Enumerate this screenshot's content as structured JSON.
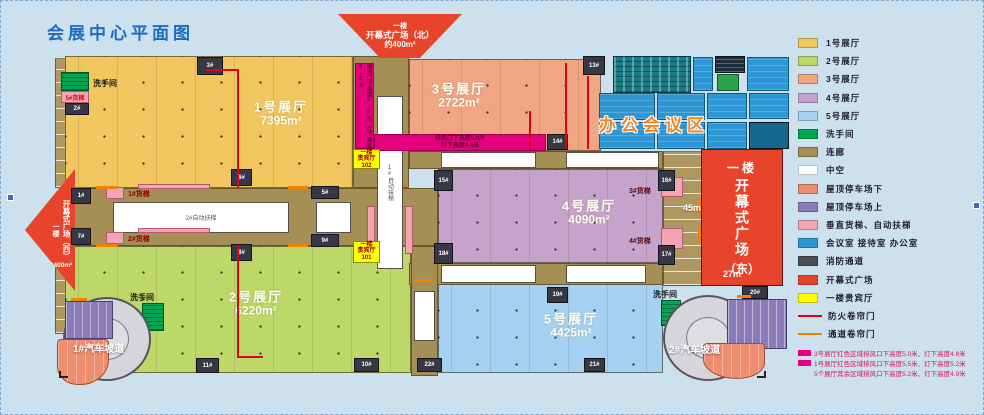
{
  "title": "会展中心平面图",
  "halls": {
    "h1": {
      "name": "1号展厅",
      "area": "7395m²"
    },
    "h2": {
      "name": "2号展厅",
      "area": "6220m²"
    },
    "h3": {
      "name": "3号展厅",
      "area": "2722m²"
    },
    "h4": {
      "name": "4号展厅",
      "area": "4090m²"
    },
    "h5": {
      "name": "5号展厅",
      "area": "4425m²"
    }
  },
  "plazas": {
    "north": {
      "floor": "一楼",
      "name": "开幕式广场（北）",
      "area": "约400m²"
    },
    "west": {
      "floor": "一楼",
      "name": "开幕式广场（西）",
      "area": "约400m²"
    },
    "east": {
      "floor": "一楼",
      "name": "开幕式广场",
      "region": "（东）",
      "dim_left": "45m",
      "dim_bottom": "27m"
    }
  },
  "office_zone": {
    "label": "办公会议区"
  },
  "vip": {
    "r102": {
      "line1": "一楼",
      "line2": "贵宾厅",
      "line3": "102"
    },
    "r101": {
      "line1": "一楼",
      "line2": "贵宾厅",
      "line3": "101"
    }
  },
  "freight": {
    "e1": "1#货梯",
    "e2": "2#货梯",
    "e3": "3#货梯",
    "e4": "4#货梯",
    "e5": "5#货梯"
  },
  "escalators": {
    "e1": "1#自动扶梯",
    "e2": "2#自动扶梯"
  },
  "restroom_label": "洗手间",
  "ramps": {
    "r1": "1#汽车坡道",
    "r2": "2#汽车坡道"
  },
  "vents": {
    "v_text": "排风口下高度5.5米、灯下高度5.2米",
    "h_line1": "排风口下高度5.0米",
    "h_line2": "灯下高度4.8米"
  },
  "stairs": [
    "1#",
    "2#",
    "3#",
    "5#",
    "6#",
    "7#",
    "8#",
    "9#",
    "10#",
    "11#",
    "13#",
    "14#",
    "15#",
    "16#",
    "17#",
    "18#",
    "19#",
    "20#",
    "21#",
    "22#"
  ],
  "legend": {
    "items": [
      {
        "label": "1号展厅",
        "color": "#f2c75f",
        "type": "swatch"
      },
      {
        "label": "2号展厅",
        "color": "#bdd868",
        "type": "swatch"
      },
      {
        "label": "3号展厅",
        "color": "#f2a583",
        "type": "swatch"
      },
      {
        "label": "4号展厅",
        "color": "#c6a3cb",
        "type": "swatch"
      },
      {
        "label": "5号展厅",
        "color": "#a5d2f2",
        "type": "swatch"
      },
      {
        "label": "洗手间",
        "color": "#00a651",
        "type": "swatch"
      },
      {
        "label": "连廊",
        "color": "#a68f55",
        "type": "swatch"
      },
      {
        "label": "中空",
        "color": "#ffffff",
        "type": "swatch"
      },
      {
        "label": "屋顶停车场下",
        "color": "#ef8d71",
        "type": "swatch"
      },
      {
        "label": "屋顶停车场上",
        "color": "#8a7cba",
        "type": "swatch"
      },
      {
        "label": "垂直货梯、自动扶梯",
        "color": "#f2a6b4",
        "type": "swatch"
      },
      {
        "label": "会议室 接待室 办公室",
        "color": "#2d96d3",
        "type": "swatch"
      },
      {
        "label": "消防通道",
        "color": "#4d4d55",
        "type": "swatch"
      },
      {
        "label": "开幕式广场",
        "color": "#e8432b",
        "type": "swatch"
      },
      {
        "label": "一楼贵宾厅",
        "color": "#ffff00",
        "type": "swatch"
      },
      {
        "label": "防火卷帘门",
        "color": "#e50012",
        "type": "line"
      },
      {
        "label": "通道卷帘门",
        "color": "#f08300",
        "type": "line"
      }
    ],
    "notes": [
      {
        "text": "3号展厅红色区域排风口下高度5.0米、灯下高度4.8米",
        "swatch": true
      },
      {
        "text": "1号展厅红色区域排风口下高度5.5米、灯下高度5.2米",
        "swatch": true
      },
      {
        "text": "5个展厅其余区域排风口下高度5.2米、灯下高度4.9米",
        "swatch": false
      }
    ]
  },
  "colors": {
    "background": "#cde0ee",
    "corridor": "#a68f55",
    "plaza": "#e8432b",
    "fire_line": "#e50012",
    "passage_line": "#f08300",
    "vent_strip": "#e5007d",
    "title": "#1d6cc0",
    "office_label": "#f5831f"
  }
}
